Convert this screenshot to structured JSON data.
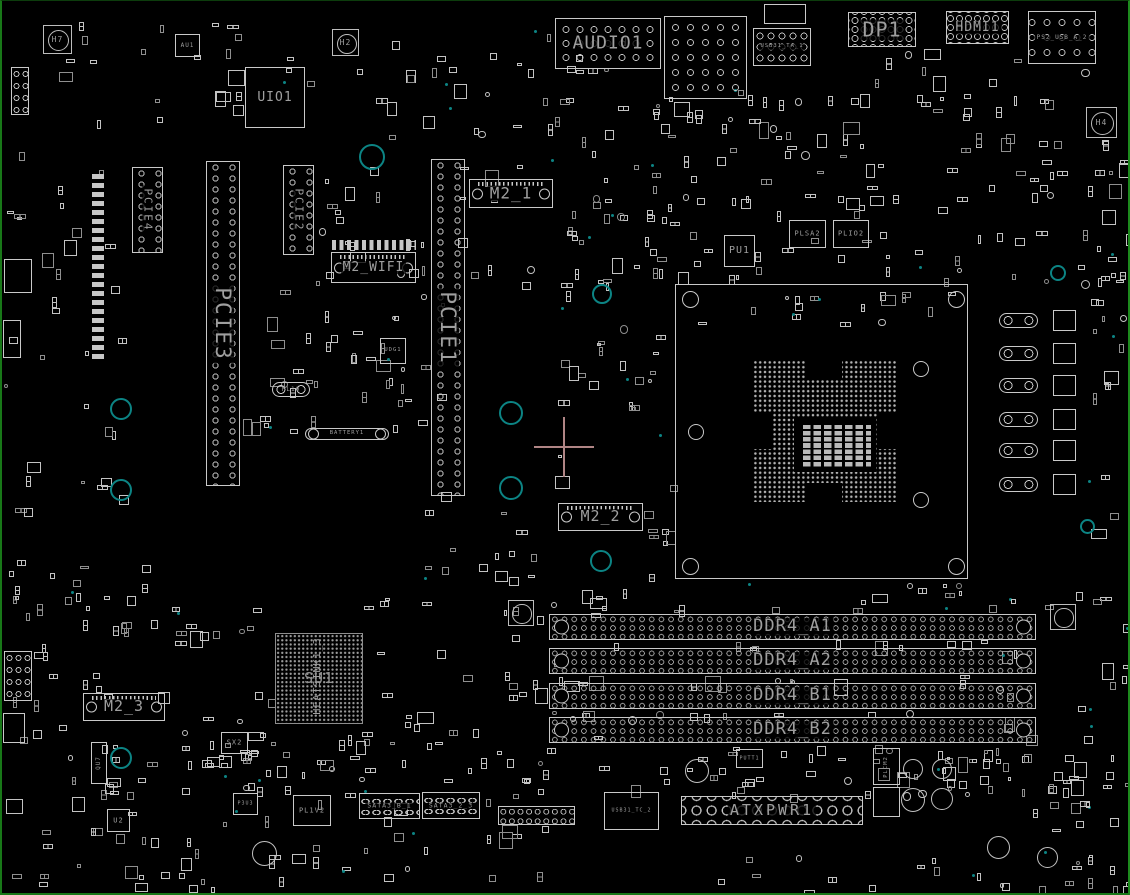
{
  "diagram": {
    "type": "pcb-boardview-silkscreen",
    "background": "#000000",
    "board_edge_color": "#1a7a1a",
    "outline_color": "#c9c9c9",
    "label_color": "#9f9f9f",
    "teal_marker_color": "#0c8484",
    "crosshair_color": "#b08585"
  },
  "components": [
    {
      "id": "audio1-connector",
      "type": "conn-holes",
      "label": "AUDIO1",
      "x": 553,
      "y": 17,
      "w": 106,
      "h": 51,
      "fs": 18,
      "ring": "14px 14px"
    },
    {
      "id": "usb-stack-connector",
      "type": "conn-holes",
      "label": "",
      "x": 662,
      "y": 15,
      "w": 83,
      "h": 83,
      "fs": 0,
      "ring": "15px 15px"
    },
    {
      "id": "usb31-ta-cage",
      "type": "conn",
      "label": "",
      "x": 762,
      "y": 3,
      "w": 42,
      "h": 20,
      "fs": 0
    },
    {
      "id": "usb31-ta-1-connector",
      "type": "conn-holes",
      "label": "USB31_TA_1",
      "x": 751,
      "y": 27,
      "w": 58,
      "h": 38,
      "fs": 5.5,
      "ring": "11px 11px"
    },
    {
      "id": "dp1-connector",
      "type": "conn-holes",
      "label": "DP1",
      "x": 846,
      "y": 11,
      "w": 68,
      "h": 35,
      "fs": 20,
      "ring": "9px 9px"
    },
    {
      "id": "hdmi1-connector",
      "type": "conn-holes",
      "label": "HDMI1",
      "x": 944,
      "y": 10,
      "w": 63,
      "h": 33,
      "fs": 13,
      "ring": "9px 9px"
    },
    {
      "id": "ps2-usb-a-2-connector",
      "type": "conn-holes",
      "label": "PS2_USB_A_2",
      "x": 1026,
      "y": 10,
      "w": 68,
      "h": 53,
      "fs": 6,
      "ring": "15px 15px"
    },
    {
      "id": "mounting-hole-h7",
      "type": "hole",
      "label": "H7",
      "x": 41,
      "y": 24,
      "w": 29,
      "h": 29,
      "fs": 8
    },
    {
      "id": "mounting-hole-h2",
      "type": "hole",
      "label": "H2",
      "x": 330,
      "y": 28,
      "w": 27,
      "h": 27,
      "fs": 8
    },
    {
      "id": "mounting-hole-h4",
      "type": "hole",
      "label": "H4",
      "x": 1084,
      "y": 106,
      "w": 31,
      "h": 31,
      "fs": 8
    },
    {
      "id": "au1-chip",
      "type": "chip",
      "label": "AU1",
      "x": 173,
      "y": 33,
      "w": 25,
      "h": 23,
      "fs": 6
    },
    {
      "id": "uio1-chip",
      "type": "chip",
      "label": "UIO1",
      "x": 243,
      "y": 66,
      "w": 60,
      "h": 61,
      "fs": 13
    },
    {
      "id": "pcie4-slot",
      "type": "slot-v",
      "label": "PCIE4",
      "x": 130,
      "y": 166,
      "w": 31,
      "h": 86,
      "fs": 11
    },
    {
      "id": "pcie2-slot",
      "type": "slot-v",
      "label": "PCIE2",
      "x": 281,
      "y": 164,
      "w": 31,
      "h": 90,
      "fs": 11
    },
    {
      "id": "pcie3-slot",
      "type": "slot-v",
      "label": "PCIE3",
      "x": 204,
      "y": 160,
      "w": 34,
      "h": 325,
      "fs": 21
    },
    {
      "id": "pcie1-slot",
      "type": "slot-v",
      "label": "PCIE1",
      "x": 429,
      "y": 158,
      "w": 34,
      "h": 337,
      "fs": 21
    },
    {
      "id": "m2-1-slot",
      "type": "m2",
      "label": "M2_1",
      "x": 467,
      "y": 178,
      "w": 84,
      "h": 29,
      "fs": 16
    },
    {
      "id": "m2-wifi-padrow",
      "type": "padrow",
      "label": "",
      "x": 330,
      "y": 239,
      "w": 84,
      "h": 10,
      "fs": 0
    },
    {
      "id": "m2-wifi-slot",
      "type": "m2",
      "label": "M2_WIFI",
      "x": 329,
      "y": 251,
      "w": 85,
      "h": 31,
      "fs": 13
    },
    {
      "id": "pu1-chip",
      "type": "chip",
      "label": "PU1",
      "x": 722,
      "y": 234,
      "w": 31,
      "h": 32,
      "fs": 10
    },
    {
      "id": "plsa2-chip",
      "type": "chip",
      "label": "PLSA2",
      "x": 787,
      "y": 219,
      "w": 37,
      "h": 28,
      "fs": 7
    },
    {
      "id": "plio2-chip",
      "type": "chip",
      "label": "PLIO2",
      "x": 831,
      "y": 219,
      "w": 36,
      "h": 28,
      "fs": 7
    },
    {
      "id": "cpu-socket",
      "type": "socket",
      "label": "",
      "x": 673,
      "y": 283,
      "w": 293,
      "h": 295,
      "fs": 0
    },
    {
      "id": "m2-2-slot",
      "type": "m2",
      "label": "M2_2",
      "x": 556,
      "y": 502,
      "w": 85,
      "h": 28,
      "fs": 15
    },
    {
      "id": "udg1-chip",
      "type": "chip",
      "label": "UDG1",
      "x": 378,
      "y": 337,
      "w": 26,
      "h": 26,
      "fs": 5.5
    },
    {
      "id": "pl10-inductor",
      "type": "ind",
      "label": "PL10",
      "x": 270,
      "y": 381,
      "w": 38,
      "h": 15,
      "fs": 6
    },
    {
      "id": "battery1",
      "type": "battery",
      "label": "BATTERY1",
      "x": 303,
      "y": 427,
      "w": 84,
      "h": 12,
      "fs": 5.5
    },
    {
      "id": "su1-chipset-bga",
      "type": "bga",
      "label": "SU1",
      "x": 273,
      "y": 632,
      "w": 88,
      "h": 91,
      "fs": 15
    },
    {
      "id": "heatsink1-3-label",
      "type": "vlabel",
      "label": "HEATSINK1_3",
      "x": 306,
      "y": 608,
      "w": 20,
      "h": 134,
      "fs": 10
    },
    {
      "id": "m2-3-slot",
      "type": "m2",
      "label": "M2_3",
      "x": 81,
      "y": 692,
      "w": 82,
      "h": 28,
      "fs": 15
    },
    {
      "id": "sx2-chip",
      "type": "chip",
      "label": "SX2",
      "x": 219,
      "y": 731,
      "w": 27,
      "h": 22,
      "fs": 7
    },
    {
      "id": "qu7-chip",
      "type": "vchip",
      "label": "QU7",
      "x": 89,
      "y": 741,
      "w": 16,
      "h": 42,
      "fs": 6
    },
    {
      "id": "ddr4-a1-slot",
      "type": "dimm",
      "label": "DDR4_A1",
      "x": 547,
      "y": 613,
      "w": 487,
      "h": 26,
      "fs": 17
    },
    {
      "id": "ddr4-a2-slot",
      "type": "dimm",
      "label": "DDR4_A2",
      "x": 547,
      "y": 647,
      "w": 487,
      "h": 26,
      "fs": 17
    },
    {
      "id": "ddr4-b1-slot",
      "type": "dimm",
      "label": "DDR4_B1",
      "x": 547,
      "y": 682,
      "w": 487,
      "h": 26,
      "fs": 17
    },
    {
      "id": "ddr4-b2-slot",
      "type": "dimm",
      "label": "DDR4_B2",
      "x": 547,
      "y": 716,
      "w": 487,
      "h": 26,
      "fs": 17
    },
    {
      "id": "mounting-hole-mid",
      "type": "hole",
      "label": "",
      "x": 506,
      "y": 599,
      "w": 26,
      "h": 26,
      "fs": 7
    },
    {
      "id": "mounting-hole-right",
      "type": "hole",
      "label": "",
      "x": 1048,
      "y": 603,
      "w": 26,
      "h": 26,
      "fs": 7
    },
    {
      "id": "atxpwr1-connector",
      "type": "atx",
      "label": "ATXPWR1",
      "x": 679,
      "y": 795,
      "w": 182,
      "h": 29,
      "fs": 15
    },
    {
      "id": "putt1-chip",
      "type": "chip",
      "label": "PUTT1",
      "x": 734,
      "y": 748,
      "w": 27,
      "h": 19,
      "fs": 5
    },
    {
      "id": "usb31-tc-2-connector",
      "type": "conn",
      "label": "USB31_TC_2",
      "x": 602,
      "y": 791,
      "w": 55,
      "h": 38,
      "fs": 5
    },
    {
      "id": "plcm2-chip",
      "type": "vchip",
      "label": "PLCM2",
      "x": 871,
      "y": 747,
      "w": 27,
      "h": 37,
      "fs": 5.5
    },
    {
      "id": "plcm-chip-2",
      "type": "vchip",
      "label": "",
      "x": 871,
      "y": 786,
      "w": 27,
      "h": 30,
      "fs": 0
    },
    {
      "id": "sata3-b-1-connector",
      "type": "sata",
      "label": "SATA3_B_1",
      "x": 357,
      "y": 792,
      "w": 61,
      "h": 26,
      "fs": 6.5
    },
    {
      "id": "sata3-2-3-connector",
      "type": "sata",
      "label": "SATA3_2_3",
      "x": 420,
      "y": 791,
      "w": 58,
      "h": 27,
      "fs": 6.5
    },
    {
      "id": "front-panel-header",
      "type": "header",
      "label": "",
      "x": 496,
      "y": 805,
      "w": 77,
      "h": 19,
      "fs": 0
    },
    {
      "id": "pl1v2-inductor",
      "type": "conn",
      "label": "PL1V2",
      "x": 291,
      "y": 794,
      "w": 38,
      "h": 31,
      "fs": 7
    },
    {
      "id": "p3u3-chip",
      "type": "chip",
      "label": "P3U3",
      "x": 231,
      "y": 792,
      "w": 25,
      "h": 22,
      "fs": 5
    },
    {
      "id": "u2-chip",
      "type": "chip",
      "label": "U2",
      "x": 105,
      "y": 808,
      "w": 23,
      "h": 23,
      "fs": 7
    },
    {
      "id": "vrm-inductor-1",
      "type": "ind",
      "label": "",
      "x": 997,
      "y": 312,
      "w": 39,
      "h": 15,
      "fs": 0
    },
    {
      "id": "vrm-inductor-2",
      "type": "ind",
      "label": "",
      "x": 997,
      "y": 345,
      "w": 39,
      "h": 15,
      "fs": 0
    },
    {
      "id": "vrm-inductor-3",
      "type": "ind",
      "label": "",
      "x": 997,
      "y": 377,
      "w": 39,
      "h": 15,
      "fs": 0
    },
    {
      "id": "vrm-inductor-4",
      "type": "ind",
      "label": "",
      "x": 997,
      "y": 411,
      "w": 39,
      "h": 15,
      "fs": 0
    },
    {
      "id": "vrm-inductor-5",
      "type": "ind",
      "label": "",
      "x": 997,
      "y": 442,
      "w": 39,
      "h": 15,
      "fs": 0
    },
    {
      "id": "vrm-inductor-6",
      "type": "ind",
      "label": "",
      "x": 997,
      "y": 476,
      "w": 39,
      "h": 15,
      "fs": 0
    },
    {
      "id": "vrm-powerstage-1",
      "type": "chip",
      "label": "",
      "x": 1051,
      "y": 309,
      "w": 23,
      "h": 21,
      "fs": 0
    },
    {
      "id": "vrm-powerstage-2",
      "type": "chip",
      "label": "",
      "x": 1051,
      "y": 342,
      "w": 23,
      "h": 21,
      "fs": 0
    },
    {
      "id": "vrm-powerstage-3",
      "type": "chip",
      "label": "",
      "x": 1051,
      "y": 374,
      "w": 23,
      "h": 21,
      "fs": 0
    },
    {
      "id": "vrm-powerstage-4",
      "type": "chip",
      "label": "",
      "x": 1051,
      "y": 408,
      "w": 23,
      "h": 21,
      "fs": 0
    },
    {
      "id": "vrm-powerstage-5",
      "type": "chip",
      "label": "",
      "x": 1051,
      "y": 439,
      "w": 23,
      "h": 21,
      "fs": 0
    },
    {
      "id": "vrm-powerstage-6",
      "type": "chip",
      "label": "",
      "x": 1051,
      "y": 473,
      "w": 23,
      "h": 21,
      "fs": 0
    },
    {
      "id": "cap-1",
      "type": "cap",
      "label": "",
      "x": 901,
      "y": 758,
      "w": 20,
      "h": 20,
      "fs": 0
    },
    {
      "id": "cap-2",
      "type": "cap",
      "label": "",
      "x": 899,
      "y": 787,
      "w": 24,
      "h": 24,
      "fs": 0
    },
    {
      "id": "cap-3",
      "type": "cap",
      "label": "",
      "x": 930,
      "y": 758,
      "w": 20,
      "h": 20,
      "fs": 0
    },
    {
      "id": "cap-4",
      "type": "cap",
      "label": "",
      "x": 929,
      "y": 787,
      "w": 22,
      "h": 22,
      "fs": 0
    },
    {
      "id": "cap-5",
      "type": "cap",
      "label": "",
      "x": 985,
      "y": 835,
      "w": 23,
      "h": 23,
      "fs": 0
    },
    {
      "id": "cap-6",
      "type": "cap",
      "label": "",
      "x": 1035,
      "y": 846,
      "w": 21,
      "h": 21,
      "fs": 0
    },
    {
      "id": "cap-7",
      "type": "cap",
      "label": "",
      "x": 250,
      "y": 840,
      "w": 25,
      "h": 25,
      "fs": 0
    },
    {
      "id": "cap-8",
      "type": "cap",
      "label": "",
      "x": 683,
      "y": 758,
      "w": 24,
      "h": 24,
      "fs": 0
    },
    {
      "id": "rear-header-1",
      "type": "header-v",
      "label": "",
      "x": 9,
      "y": 66,
      "w": 18,
      "h": 48,
      "fs": 0
    },
    {
      "id": "left-conn-1",
      "type": "conn",
      "label": "",
      "x": 2,
      "y": 258,
      "w": 28,
      "h": 34,
      "fs": 0
    },
    {
      "id": "left-conn-2",
      "type": "conn",
      "label": "",
      "x": 1,
      "y": 319,
      "w": 18,
      "h": 38,
      "fs": 0
    },
    {
      "id": "left-header-2",
      "type": "header-v",
      "label": "",
      "x": 2,
      "y": 650,
      "w": 28,
      "h": 50,
      "fs": 0
    },
    {
      "id": "left-conn-3",
      "type": "conn",
      "label": "",
      "x": 1,
      "y": 712,
      "w": 22,
      "h": 30,
      "fs": 0
    },
    {
      "id": "left-padcol",
      "type": "padcol",
      "label": "",
      "x": 90,
      "y": 173,
      "w": 12,
      "h": 185,
      "fs": 0
    },
    {
      "id": "teal-ring-1",
      "type": "teal",
      "label": "",
      "x": 357,
      "y": 143,
      "w": 26,
      "h": 26,
      "fs": 0
    },
    {
      "id": "teal-ring-2",
      "type": "teal",
      "label": "",
      "x": 108,
      "y": 397,
      "w": 22,
      "h": 22,
      "fs": 0
    },
    {
      "id": "teal-ring-3",
      "type": "teal",
      "label": "",
      "x": 108,
      "y": 478,
      "w": 22,
      "h": 22,
      "fs": 0
    },
    {
      "id": "teal-ring-4",
      "type": "teal",
      "label": "",
      "x": 497,
      "y": 400,
      "w": 24,
      "h": 24,
      "fs": 0
    },
    {
      "id": "teal-ring-5",
      "type": "teal",
      "label": "",
      "x": 497,
      "y": 475,
      "w": 24,
      "h": 24,
      "fs": 0
    },
    {
      "id": "teal-ring-6",
      "type": "teal",
      "label": "",
      "x": 590,
      "y": 283,
      "w": 20,
      "h": 20,
      "fs": 0
    },
    {
      "id": "teal-ring-7",
      "type": "teal",
      "label": "",
      "x": 588,
      "y": 549,
      "w": 22,
      "h": 22,
      "fs": 0
    },
    {
      "id": "teal-ring-8",
      "type": "teal",
      "label": "",
      "x": 108,
      "y": 746,
      "w": 22,
      "h": 22,
      "fs": 0
    },
    {
      "id": "teal-ring-9",
      "type": "teal",
      "label": "",
      "x": 1048,
      "y": 264,
      "w": 16,
      "h": 16,
      "fs": 0
    },
    {
      "id": "teal-ring-10",
      "type": "teal",
      "label": "",
      "x": 1078,
      "y": 518,
      "w": 15,
      "h": 15,
      "fs": 0
    },
    {
      "id": "origin-crosshair",
      "type": "cross",
      "label": "",
      "x": 532,
      "y": 416,
      "w": 60,
      "h": 60,
      "fs": 0
    }
  ]
}
